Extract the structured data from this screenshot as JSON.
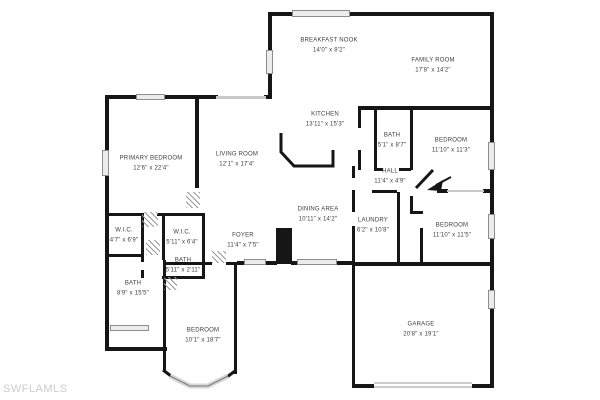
{
  "watermark": "SWFLAMLS",
  "colors": {
    "wall": "#161616",
    "window": "#ececec",
    "label_text": "#3d3d3d",
    "watermark": "#cccccc"
  },
  "rooms": [
    {
      "name": "BREAKFAST NOOK",
      "dims": "14'0\" x 8'2\""
    },
    {
      "name": "FAMILY ROOM",
      "dims": "17'8\" x 14'2\""
    },
    {
      "name": "KITCHEN",
      "dims": "13'11\" x 15'3\""
    },
    {
      "name": "BATH",
      "dims": "5'1\" x 8'7\""
    },
    {
      "name": "BEDROOM",
      "dims": "11'10\" x 11'3\""
    },
    {
      "name": "PRIMARY BEDROOM",
      "dims": "12'6\" x 22'4\""
    },
    {
      "name": "LIVING ROOM",
      "dims": "12'1\" x 17'4\""
    },
    {
      "name": "HALL",
      "dims": "11'4\" x 4'9\""
    },
    {
      "name": "DINING AREA",
      "dims": "10'11\" x 14'2\""
    },
    {
      "name": "LAUNDRY",
      "dims": "6'2\" x 10'8\""
    },
    {
      "name": "BEDROOM",
      "dims": "11'10\" x 11'5\""
    },
    {
      "name": "W.I.C.",
      "dims": "4'7\" x 6'9\""
    },
    {
      "name": "W.I.C.",
      "dims": "5'11\" x 6'4\""
    },
    {
      "name": "FOYER",
      "dims": "11'4\" x 7'5\""
    },
    {
      "name": "BATH",
      "dims": "5'11\" x 2'11\""
    },
    {
      "name": "BATH",
      "dims": "8'9\" x 15'5\""
    },
    {
      "name": "BEDROOM",
      "dims": "10'1\" x 18'7\""
    },
    {
      "name": "GARAGE",
      "dims": "20'8\" x 19'1\""
    }
  ]
}
